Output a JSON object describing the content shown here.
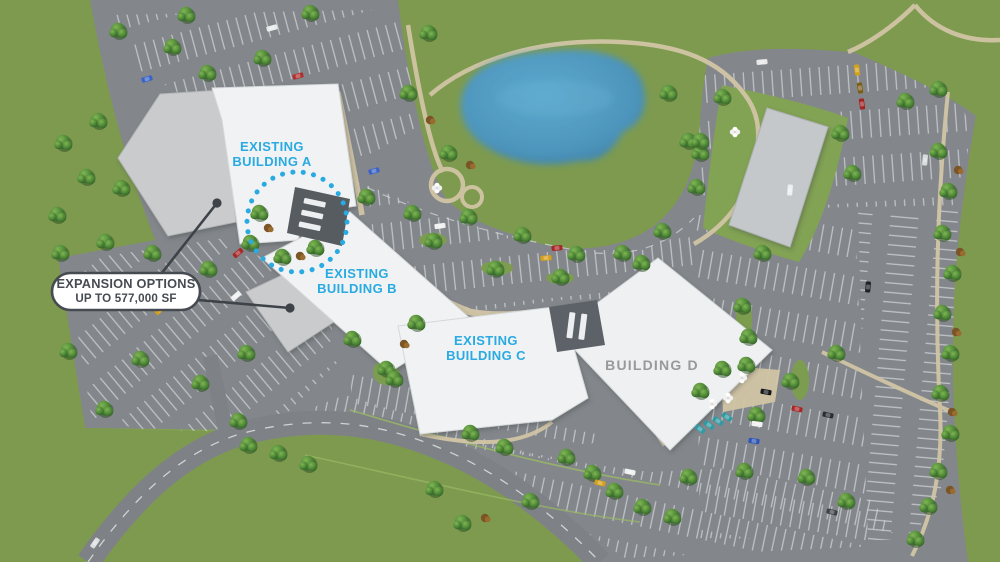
{
  "buildings": {
    "a": {
      "line1": "EXISTING",
      "line2": "BUILDING A"
    },
    "b": {
      "line1": "EXISTING",
      "line2": "BUILDING B"
    },
    "c": {
      "line1": "EXISTING",
      "line2": "BUILDING C"
    },
    "d": {
      "label": "BUILDING D"
    }
  },
  "callout": {
    "line1": "EXPANSION OPTIONS",
    "line2": "UP TO 577,000 SF"
  },
  "colors": {
    "accent_cyan": "#29ABE2",
    "callout_text": "#464B52",
    "building_d_label": "#97999C",
    "grass": "#7D9A4F",
    "asphalt": "#83878B",
    "pond": "#4E95BC",
    "building_white": "#F0F2F4",
    "expansion_gray": "#C9CBCD"
  }
}
